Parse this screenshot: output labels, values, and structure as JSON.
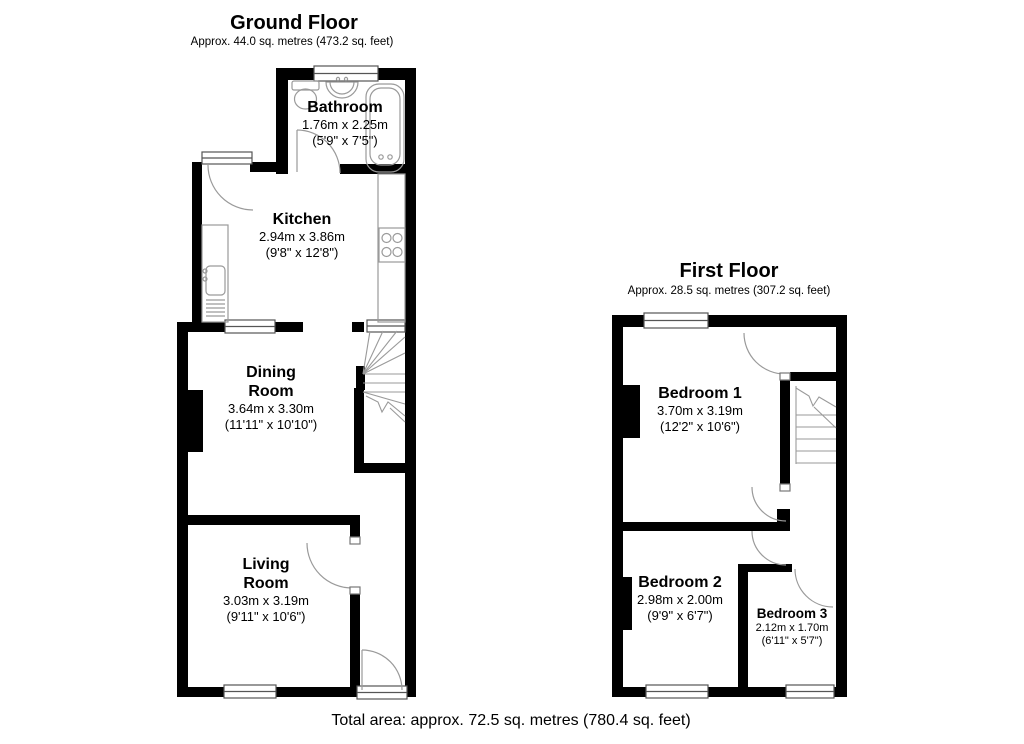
{
  "page": {
    "footer": "Total area: approx. 72.5 sq. metres (780.4 sq. feet)",
    "colors": {
      "wall": "#000000",
      "line": "#9a9a9a",
      "text": "#000000",
      "background": "#ffffff"
    }
  },
  "floors": [
    {
      "id": "ground-floor",
      "title": "Ground Floor",
      "subtitle": "Approx. 44.0 sq. metres (473.2 sq. feet)",
      "rooms": [
        {
          "name": "Bathroom",
          "metric": "1.76m x 2.25m",
          "imperial": "(5'9\" x 7'5\")"
        },
        {
          "name": "Kitchen",
          "metric": "2.94m x 3.86m",
          "imperial": "(9'8\" x 12'8\")"
        },
        {
          "name": "Dining Room",
          "metric": "3.64m x 3.30m",
          "imperial": "(11'11\" x 10'10\")"
        },
        {
          "name": "Living Room",
          "metric": "3.03m x 3.19m",
          "imperial": "(9'11\" x 10'6\")"
        }
      ]
    },
    {
      "id": "first-floor",
      "title": "First Floor",
      "subtitle": "Approx. 28.5 sq. metres (307.2 sq. feet)",
      "rooms": [
        {
          "name": "Bedroom 1",
          "metric": "3.70m x 3.19m",
          "imperial": "(12'2\" x 10'6\")"
        },
        {
          "name": "Bedroom 2",
          "metric": "2.98m x 2.00m",
          "imperial": "(9'9\" x 6'7\")"
        },
        {
          "name": "Bedroom 3",
          "metric": "2.12m x 1.70m",
          "imperial": "(6'11\" x 5'7\")"
        }
      ]
    }
  ]
}
